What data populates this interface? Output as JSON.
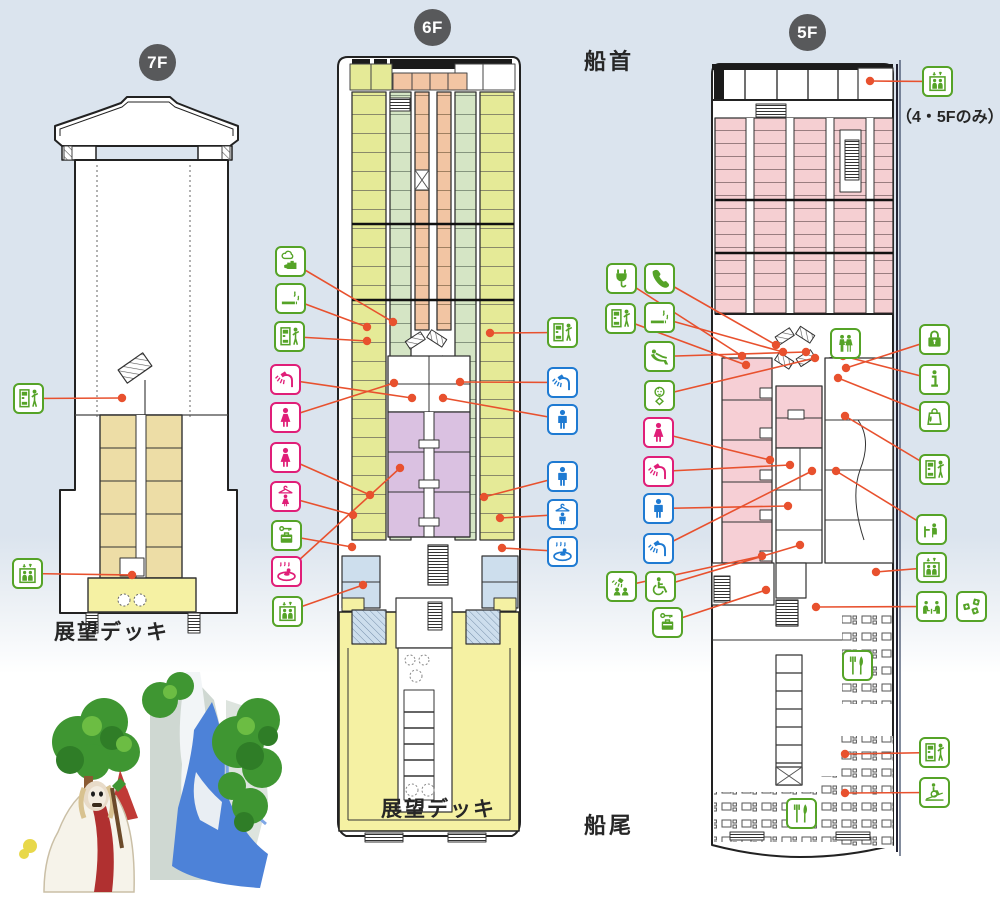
{
  "page": {
    "bow_label": "船首",
    "stern_label": "船尾",
    "note_45f": "（4・5Fのみ）"
  },
  "floors": [
    {
      "id": "7F",
      "badge": "7F",
      "deck_label": "展望デッキ"
    },
    {
      "id": "6F",
      "badge": "6F",
      "deck_label": "展望デッキ"
    },
    {
      "id": "5F",
      "badge": "5F"
    }
  ],
  "colors": {
    "icon_green": "#55a327",
    "icon_pink": "#e01e78",
    "icon_blue": "#1e7ad2",
    "leader_line": "#e8512e",
    "badge_gray": "#58595b",
    "background_blue": "#dbe4ee",
    "cabin_yellow_green": "#e5ea97",
    "cabin_pale_green": "#d5e5c5",
    "cabin_salmon": "#f2c5a3",
    "cabin_pink": "#f5cfd2",
    "cabin_tan": "#eddda6",
    "bath_purple": "#dac1e1",
    "deck_yellow": "#f5f1a3",
    "room_blue": "#cddeed"
  },
  "icons": [
    {
      "name": "vending-machine-icon-7f",
      "type": "vending",
      "color": "green",
      "x": 13,
      "y": 383,
      "tx": 122,
      "ty": 398
    },
    {
      "name": "elevator-icon-7f",
      "type": "elevator",
      "color": "green",
      "x": 12,
      "y": 558,
      "tx": 132,
      "ty": 575
    },
    {
      "name": "elevator-icon-5f-bow",
      "type": "elevator",
      "color": "green",
      "x": 922,
      "y": 66,
      "tx": 870,
      "ty": 81
    },
    {
      "name": "hot-water-icon-6f",
      "type": "hotwater",
      "color": "green",
      "x": 275,
      "y": 246,
      "tx": 393,
      "ty": 322
    },
    {
      "name": "smoking-area-icon-6f",
      "type": "smoking",
      "color": "green",
      "x": 275,
      "y": 283,
      "tx": 367,
      "ty": 327
    },
    {
      "name": "vending-machine-icon-6f-left",
      "type": "vending",
      "color": "green",
      "x": 274,
      "y": 321,
      "tx": 367,
      "ty": 341
    },
    {
      "name": "women-shower-icon-6f",
      "type": "shower",
      "color": "pink",
      "x": 270,
      "y": 364,
      "tx": 412,
      "ty": 398
    },
    {
      "name": "women-toilet-icon-6f",
      "type": "woman",
      "color": "pink",
      "x": 270,
      "y": 402,
      "tx": 394,
      "ty": 383
    },
    {
      "name": "women-washroom-icon-6f",
      "type": "woman",
      "color": "pink",
      "x": 270,
      "y": 442,
      "tx": 370,
      "ty": 495
    },
    {
      "name": "women-dressing-room-icon-6f",
      "type": "dress-w",
      "color": "pink",
      "x": 270,
      "y": 481,
      "tx": 353,
      "ty": 515
    },
    {
      "name": "coin-locker-icon-6f",
      "type": "locker",
      "color": "green",
      "x": 271,
      "y": 520,
      "tx": 352,
      "ty": 547
    },
    {
      "name": "women-bath-icon-6f",
      "type": "bath",
      "color": "pink",
      "x": 271,
      "y": 556,
      "tx": 400,
      "ty": 468
    },
    {
      "name": "elevator-icon-6f",
      "type": "elevator",
      "color": "green",
      "x": 272,
      "y": 596,
      "tx": 363,
      "ty": 585
    },
    {
      "name": "vending-machine-icon-6f-right",
      "type": "vending",
      "color": "green",
      "x": 547,
      "y": 317,
      "tx": 490,
      "ty": 333
    },
    {
      "name": "men-shower-icon-6f",
      "type": "shower",
      "color": "blue",
      "x": 547,
      "y": 367,
      "tx": 460,
      "ty": 382
    },
    {
      "name": "men-toilet-icon-6f",
      "type": "man",
      "color": "blue",
      "x": 547,
      "y": 404,
      "tx": 443,
      "ty": 398
    },
    {
      "name": "men-washroom-icon-6f",
      "type": "man",
      "color": "blue",
      "x": 547,
      "y": 461,
      "tx": 484,
      "ty": 497
    },
    {
      "name": "men-dressing-room-icon-6f",
      "type": "dress-m",
      "color": "blue",
      "x": 547,
      "y": 499,
      "tx": 500,
      "ty": 518
    },
    {
      "name": "men-bath-icon-6f",
      "type": "bath",
      "color": "blue",
      "x": 547,
      "y": 536,
      "tx": 502,
      "ty": 548
    },
    {
      "name": "power-outlet-icon-5f",
      "type": "plug",
      "color": "green",
      "x": 606,
      "y": 263,
      "tx": 742,
      "ty": 356
    },
    {
      "name": "vending-machine-icon-5f-left1",
      "type": "vending",
      "color": "green",
      "x": 605,
      "y": 303,
      "tx": 746,
      "ty": 365
    },
    {
      "name": "telephone-icon-5f",
      "type": "phone",
      "color": "green",
      "x": 644,
      "y": 263,
      "tx": 776,
      "ty": 345
    },
    {
      "name": "smoking-area-icon-5f",
      "type": "smoking",
      "color": "green",
      "x": 644,
      "y": 302,
      "tx": 783,
      "ty": 352
    },
    {
      "name": "massage-chair-icon-5f",
      "type": "massage",
      "color": "green",
      "x": 644,
      "y": 341,
      "tx": 806,
      "ty": 352
    },
    {
      "name": "baby-room-icon-5f",
      "type": "baby",
      "color": "green",
      "x": 644,
      "y": 380,
      "tx": 815,
      "ty": 358
    },
    {
      "name": "women-toilet-icon-5f",
      "type": "woman",
      "color": "pink",
      "x": 643,
      "y": 417,
      "tx": 770,
      "ty": 460
    },
    {
      "name": "women-shower-icon-5f",
      "type": "shower",
      "color": "pink",
      "x": 643,
      "y": 456,
      "tx": 790,
      "ty": 465
    },
    {
      "name": "men-toilet-icon-5f",
      "type": "man",
      "color": "blue",
      "x": 643,
      "y": 493,
      "tx": 788,
      "ty": 506
    },
    {
      "name": "men-shower-icon-5f",
      "type": "shower",
      "color": "blue",
      "x": 643,
      "y": 533,
      "tx": 812,
      "ty": 471
    },
    {
      "name": "group-shower-icon-5f",
      "type": "group-shower",
      "color": "green",
      "x": 606,
      "y": 571,
      "tx": 762,
      "ty": 556
    },
    {
      "name": "wheelchair-accessible-icon-5f",
      "type": "wheelchair",
      "color": "green",
      "x": 645,
      "y": 571,
      "tx": 800,
      "ty": 545
    },
    {
      "name": "coin-locker-icon-5f",
      "type": "locker",
      "color": "green",
      "x": 652,
      "y": 607,
      "tx": 766,
      "ty": 590
    },
    {
      "name": "valuables-locker-icon-5f",
      "type": "lock",
      "color": "green",
      "x": 919,
      "y": 324,
      "tx": 846,
      "ty": 368
    },
    {
      "name": "information-icon-5f",
      "type": "info",
      "color": "green",
      "x": 919,
      "y": 364,
      "tx": 843,
      "ty": 356
    },
    {
      "name": "shop-icon-5f",
      "type": "bag",
      "color": "green",
      "x": 919,
      "y": 401,
      "tx": 838,
      "ty": 378
    },
    {
      "name": "vending-machine-icon-5f-right1",
      "type": "vending",
      "color": "green",
      "x": 919,
      "y": 454,
      "tx": 845,
      "ty": 416
    },
    {
      "name": "counter-seat-icon-5f",
      "type": "counter",
      "color": "green",
      "x": 916,
      "y": 514,
      "tx": 836,
      "ty": 471
    },
    {
      "name": "elevator-icon-5f",
      "type": "elevator",
      "color": "green",
      "x": 916,
      "y": 552,
      "tx": 876,
      "ty": 572
    },
    {
      "name": "lounge-seats-icon-5f",
      "type": "lounge",
      "color": "green",
      "x": 916,
      "y": 591,
      "tx": 816,
      "ty": 607
    },
    {
      "name": "game-corner-icon-5f",
      "type": "dice",
      "color": "green",
      "x": 956,
      "y": 591
    },
    {
      "name": "vending-machine-icon-5f-right2",
      "type": "vending",
      "color": "green",
      "x": 919,
      "y": 737,
      "tx": 845,
      "ty": 754
    },
    {
      "name": "wheelchair-ramp-icon-5f",
      "type": "ramp",
      "color": "green",
      "x": 919,
      "y": 777,
      "tx": 845,
      "ty": 793
    },
    {
      "name": "entrance-icon-5f",
      "type": "entrance",
      "color": "green",
      "x": 830,
      "y": 328
    },
    {
      "name": "restaurant-icon-5f-upper",
      "type": "fork",
      "color": "green",
      "x": 842,
      "y": 650
    },
    {
      "name": "restaurant-icon-5f-lower",
      "type": "fork",
      "color": "green",
      "x": 786,
      "y": 798
    }
  ]
}
